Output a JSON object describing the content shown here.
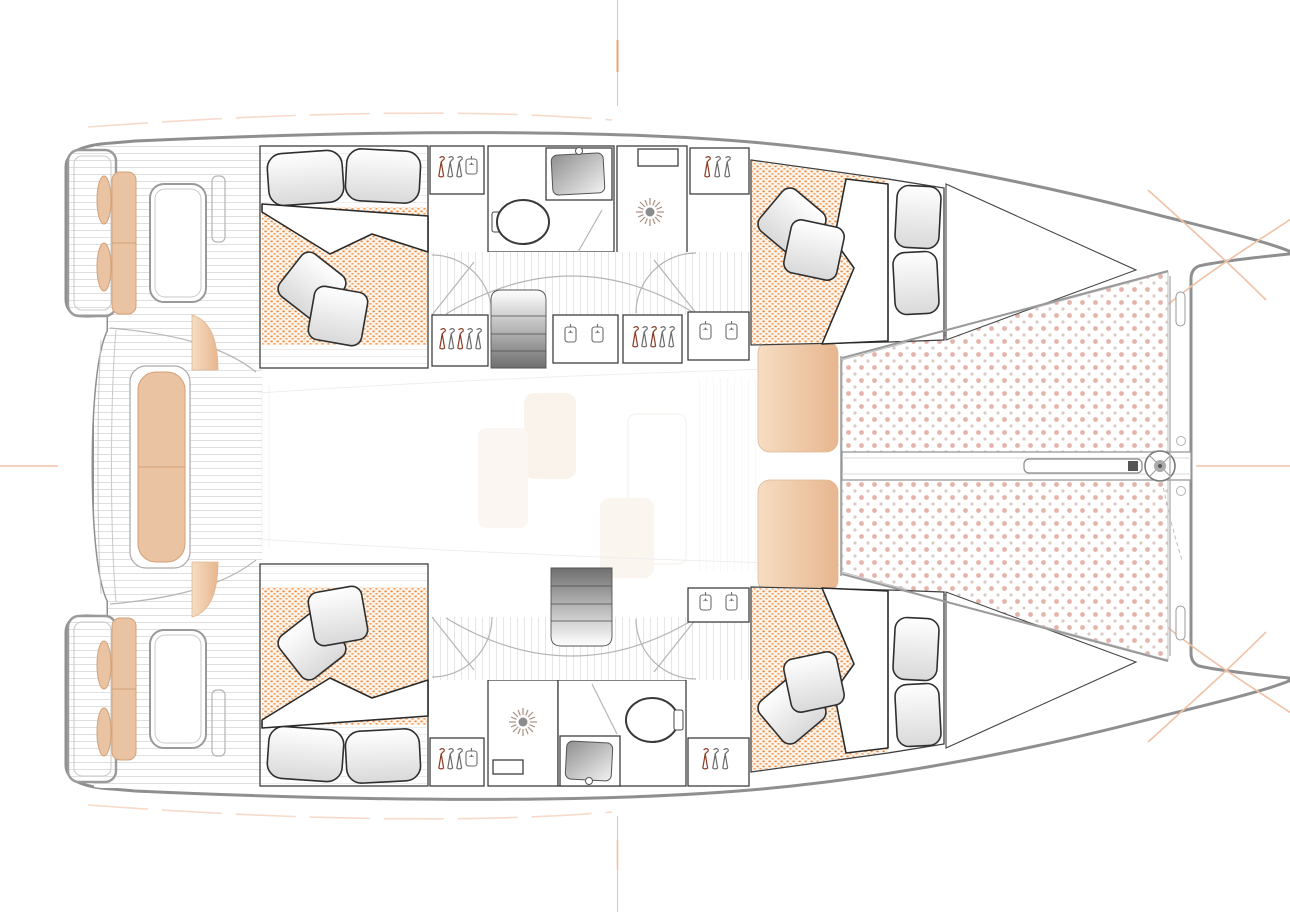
{
  "diagram": {
    "type": "catamaran-deck-plan",
    "view": "top-down",
    "orientation": "bow-right-stern-left",
    "visible_text": [],
    "vessel": {
      "hulls": 2,
      "cabins": 4,
      "heads": 2,
      "trampoline_panels": 2
    },
    "regions": {
      "stern": {
        "swim_platforms": [
          "port-swim-platform",
          "starboard-swim-platform"
        ],
        "cockpit": {
          "benches": [
            "starboard-cockpit-bench",
            "port-cockpit-bench",
            "aft-center-bench"
          ],
          "tables": [
            "starboard-cockpit-table",
            "port-cockpit-table"
          ],
          "throw_cushions": 4,
          "decking": "teak-planking"
        }
      },
      "starboard_hull": {
        "aft_cabin": {
          "bed": "double-bed",
          "pillows": 2,
          "throw_pillows": 2,
          "mattress": "orange-dotted"
        },
        "wardrobes": 4,
        "head": {
          "fixtures": [
            "toilet",
            "sink",
            "shower"
          ]
        },
        "stairs": "companionway-steps",
        "forward_cabin": {
          "bed": "double-bed-angled",
          "pillows": 2,
          "throw_pillows": 2,
          "mattress": "orange-dotted"
        }
      },
      "port_hull": {
        "aft_cabin": {
          "bed": "double-bed",
          "pillows": 2,
          "throw_pillows": 2,
          "mattress": "orange-dotted"
        },
        "wardrobes": 3,
        "head": {
          "fixtures": [
            "shower",
            "sink",
            "toilet"
          ]
        },
        "stairs": "companionway-steps",
        "forward_cabin": {
          "bed": "double-bed-angled",
          "pillows": 2,
          "throw_pillows": 2,
          "mattress": "orange-dotted"
        }
      },
      "saloon": "ghosted-faint",
      "foredeck": {
        "lounge_pads": 2,
        "trampoline": "pink-dotted-netting",
        "bowsprit": "center-beam-with-furler",
        "crossbeam": "forward-beam"
      }
    },
    "icons": [
      "hanger-icon",
      "garment-bag-icon",
      "shower-head-icon",
      "toilet-icon",
      "sink-icon",
      "furler-icon",
      "stairs-icon",
      "crosshair-mark-icon"
    ]
  },
  "colors": {
    "outline": "#8f8f8f",
    "wall": "#3f3f3f",
    "line-light": "#c9c9c9",
    "teak-line": "#dcdcdc",
    "plank-line": "#e3e3e3",
    "cushion-tan": "#e9c3a2",
    "cushion-tan-stroke": "#d3a176",
    "bed-bg": "#fdf5ec",
    "bed-dot-a": "#e8873a",
    "bed-dot-b": "#f0a264",
    "tramp-dot-pink": "#e4b3a9",
    "tramp-dot-gray": "#d8cbc6",
    "mark-orange": "#f0c2a6",
    "mark-orange-strong": "#e8a478",
    "hanger-red": "#8d3a22",
    "hanger-gray": "#6b6b6b",
    "shower-ray": "#a89080",
    "stair-dark": "#737373",
    "ghost": "#f8efe7"
  }
}
